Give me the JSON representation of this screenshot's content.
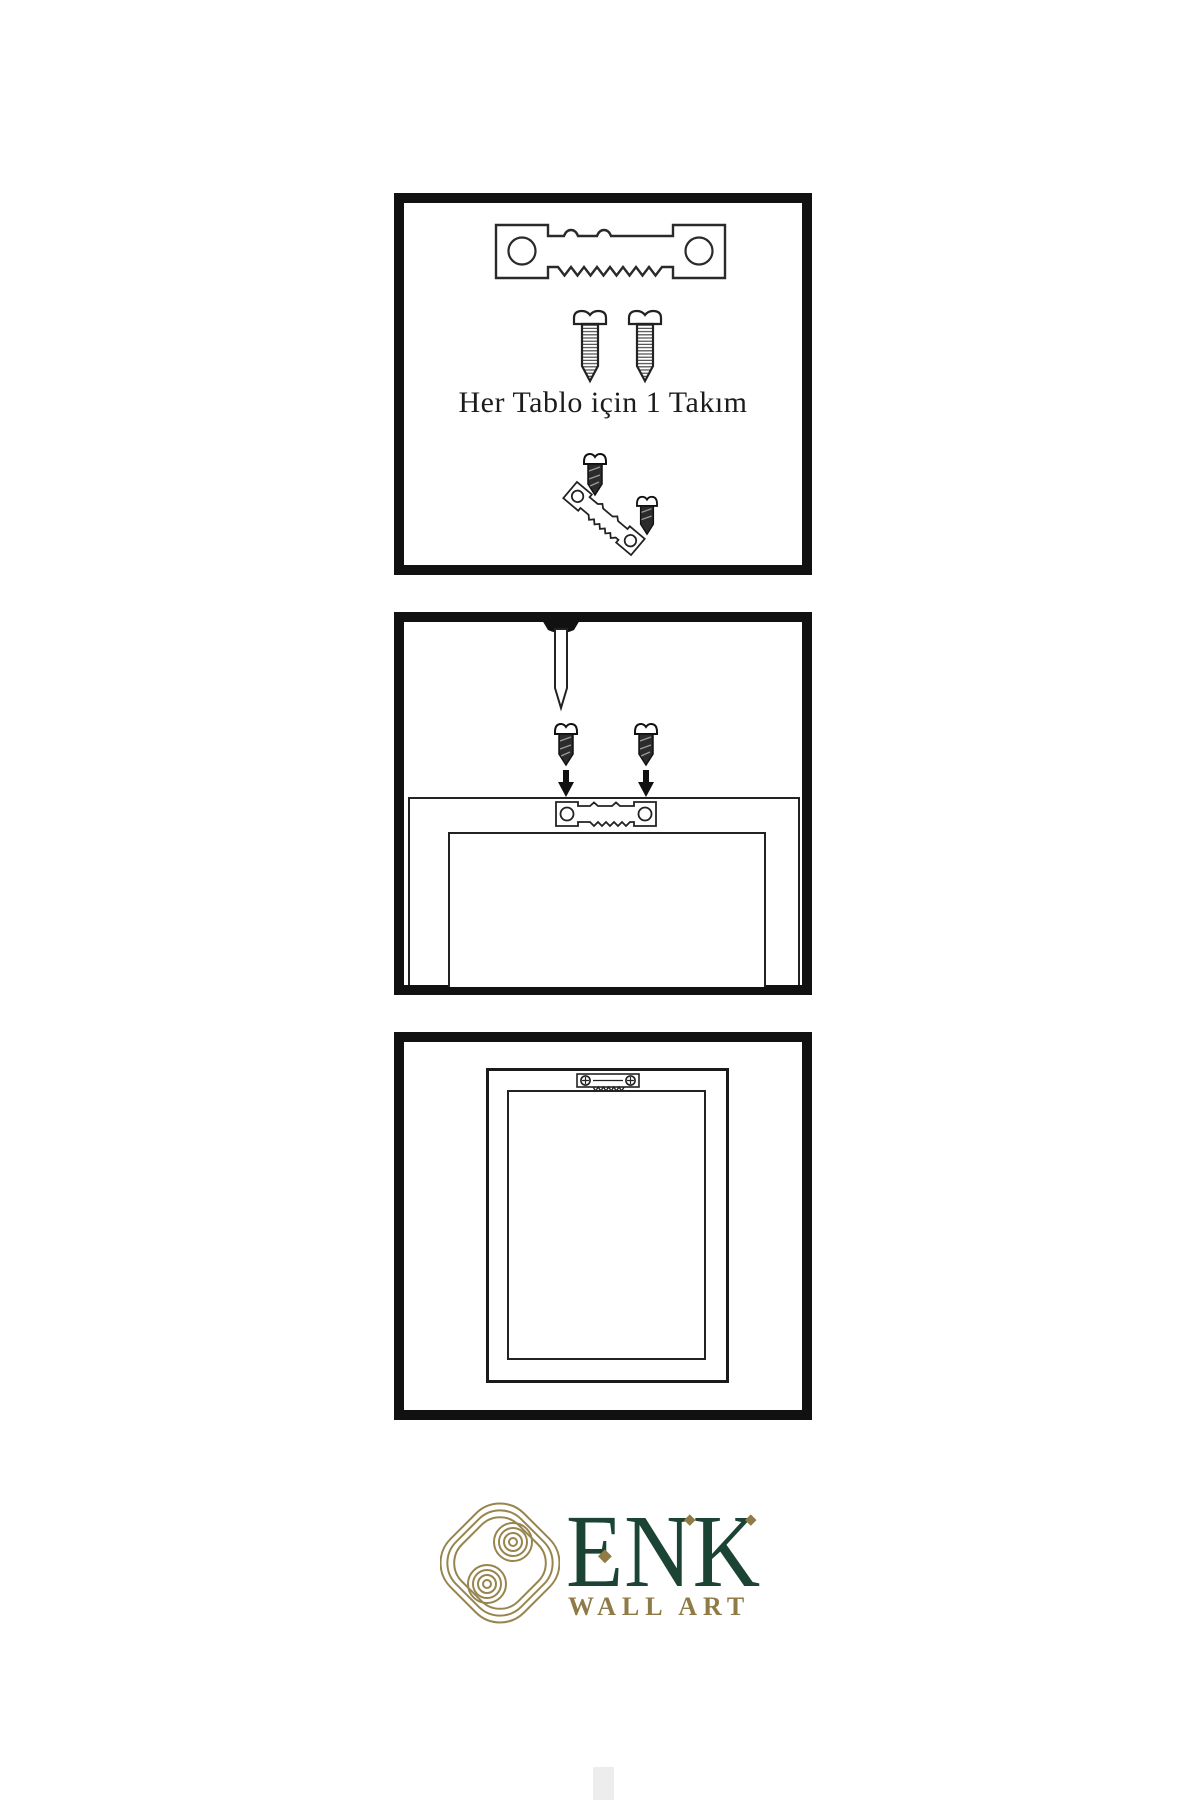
{
  "canvas": {
    "width": 1200,
    "height": 1800,
    "background": "#ffffff"
  },
  "steps": {
    "kit": {
      "caption": "Her Tablo için 1 Takım",
      "icons": [
        "sawtooth-hanger-icon",
        "screw-icon",
        "screw-icon",
        "screw-into-hanger-icon"
      ]
    },
    "mount": {
      "icons": [
        "wall-nail-icon",
        "dark-screw-icon",
        "dark-screw-icon",
        "down-arrow-icon",
        "down-arrow-icon",
        "frame-back-icon",
        "sawtooth-hanger-icon"
      ]
    },
    "hang": {
      "icons": [
        "frame-back-icon",
        "mounted-sawtooth-hanger-icon"
      ]
    }
  },
  "logo": {
    "brand": "ENK",
    "tagline": "WALL ART",
    "diamond_glyph": "◆",
    "colors": {
      "green": "#1c4434",
      "gold": "#8f7b46",
      "knot_gold": "#97854d"
    }
  },
  "artwork_colors": {
    "line": "#222222",
    "panel_border": "#111111",
    "screw_dark": "#2b2b2b"
  }
}
